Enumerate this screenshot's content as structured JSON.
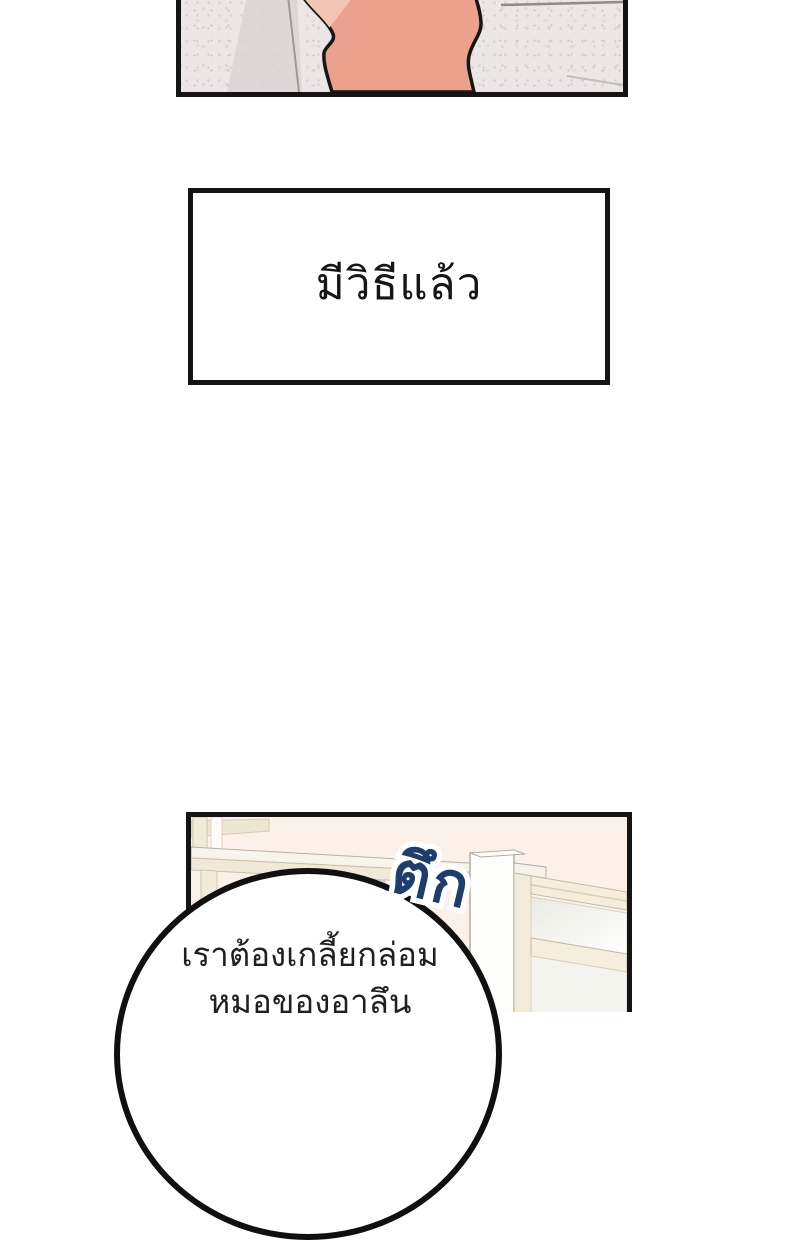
{
  "page": {
    "type": "webtoon-comic-page",
    "background_color": "#ffffff",
    "panel_border_color": "#141414"
  },
  "panels": {
    "top_panel": {
      "description": "close-up of an arm against a speckled marble tile floor",
      "skin_color": "#eba18d",
      "skin_highlight_color": "#f4c5b4",
      "tile_color": "#ece7e6"
    },
    "narration_box": {
      "text": "มีวิธีแล้ว"
    },
    "bottom_panel": {
      "description": "room interior with white pillar, cream window frames and glass partition",
      "wall_color": "#fbf1e9",
      "frame_color": "#f3ecdb"
    }
  },
  "sfx": {
    "text": "ตึก",
    "color": "#1c3d6e",
    "outline_color": "#ffffff"
  },
  "speech_bubble": {
    "line1": "เราต้องเกลี้ยกล่อม",
    "line2": "หมอของอาลึน"
  }
}
